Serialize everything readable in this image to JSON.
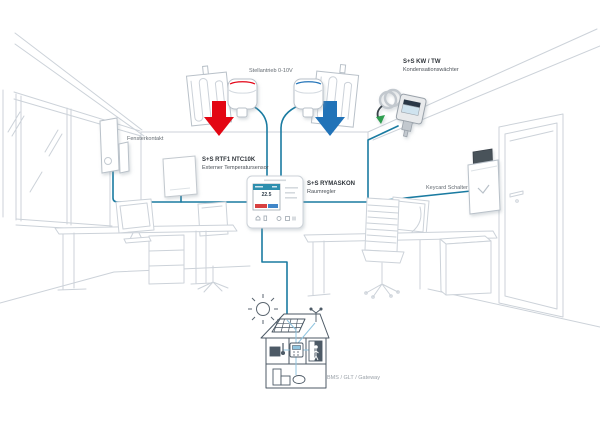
{
  "diagram": {
    "title_hint": "S+S Regeltechnik room control application diagram",
    "labels": {
      "actuator": "Stellantrieb 0-10V",
      "condensation_name": "S+S KW / TW",
      "condensation_desc": "Kondensationswächter",
      "window_contact": "Fensterkontakt",
      "temp_sensor_name": "S+S RTF1 NTC10K",
      "temp_sensor_desc": "Externer Temperatursensor",
      "controller_name": "S+S RYMASKON",
      "controller_desc": "Raumregler",
      "keycard": "Keycard Schalter",
      "bms": "BMS / GLT / Gateway"
    },
    "controller_display": {
      "temperature": "22.5"
    },
    "icons": {
      "heat_flow": "red-down-arrow",
      "cool_flow": "blue-down-arrow",
      "sun": "sun-line-icon",
      "bms_building": "building-with-solar-line-icon",
      "anemometer": "weather-station-icon"
    },
    "colors": {
      "wire": "#1a7ba1",
      "heat_arrow": "#e30613",
      "cool_arrow": "#2173b8",
      "room_lines": "#ccd2d9",
      "device_stroke": "#b9c1c9",
      "building_lines": "#4d5a66",
      "inner_wire": "#90c5e0",
      "label_dark": "#2f343a",
      "label_gray": "#646b72",
      "bms_gray": "#9aa1a8"
    }
  }
}
